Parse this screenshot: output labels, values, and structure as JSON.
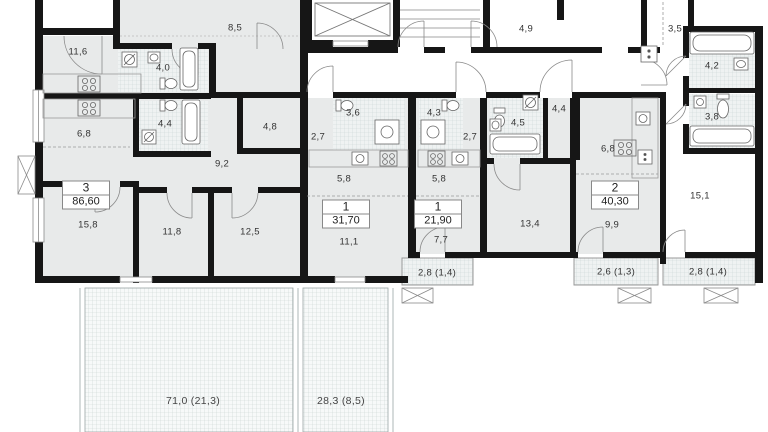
{
  "plan_title": "residential-floor-plan",
  "apartments": [
    {
      "type": "3",
      "area": "86,60"
    },
    {
      "type": "1",
      "area": "31,70"
    },
    {
      "type": "1",
      "area": "21,90"
    },
    {
      "type": "2",
      "area": "40,30"
    }
  ],
  "rooms": [
    "8,5",
    "11,6",
    "4,0",
    "4,9",
    "3,5",
    "4,2",
    "6,8",
    "4,4",
    "4,8",
    "2,7",
    "3,6",
    "4,3",
    "2,7",
    "4,5",
    "4,4",
    "3,8",
    "9,2",
    "5,8",
    "5,8",
    "6,8",
    "15,1",
    "15,8",
    "11,8",
    "12,5",
    "11,1",
    "7,7",
    "13,4",
    "9,9"
  ],
  "balconies": [
    "2,8 (1,4)",
    "2,6 (1,3)",
    "2,8 (1,4)"
  ],
  "terraces": [
    "71,0 (21,3)",
    "28,3 (8,5)"
  ],
  "icons": [
    "elevator-shaft-icon",
    "stairs-icon",
    "bathtub-icon",
    "shower-tray-icon",
    "toilet-icon",
    "sink-icon",
    "stove-icon",
    "washing-machine-icon",
    "ac-unit-icon",
    "electrical-panel-icon",
    "door-arc",
    "window"
  ],
  "colors": {
    "wall": "#161616",
    "apartment_fill": "#e8eaea",
    "tile_bg": "#eff2f2",
    "tile_line": "#ccd6d6",
    "terrace_bg": "#f7f9f9",
    "terrace_line": "#c9d4d2",
    "label": "#333333"
  }
}
